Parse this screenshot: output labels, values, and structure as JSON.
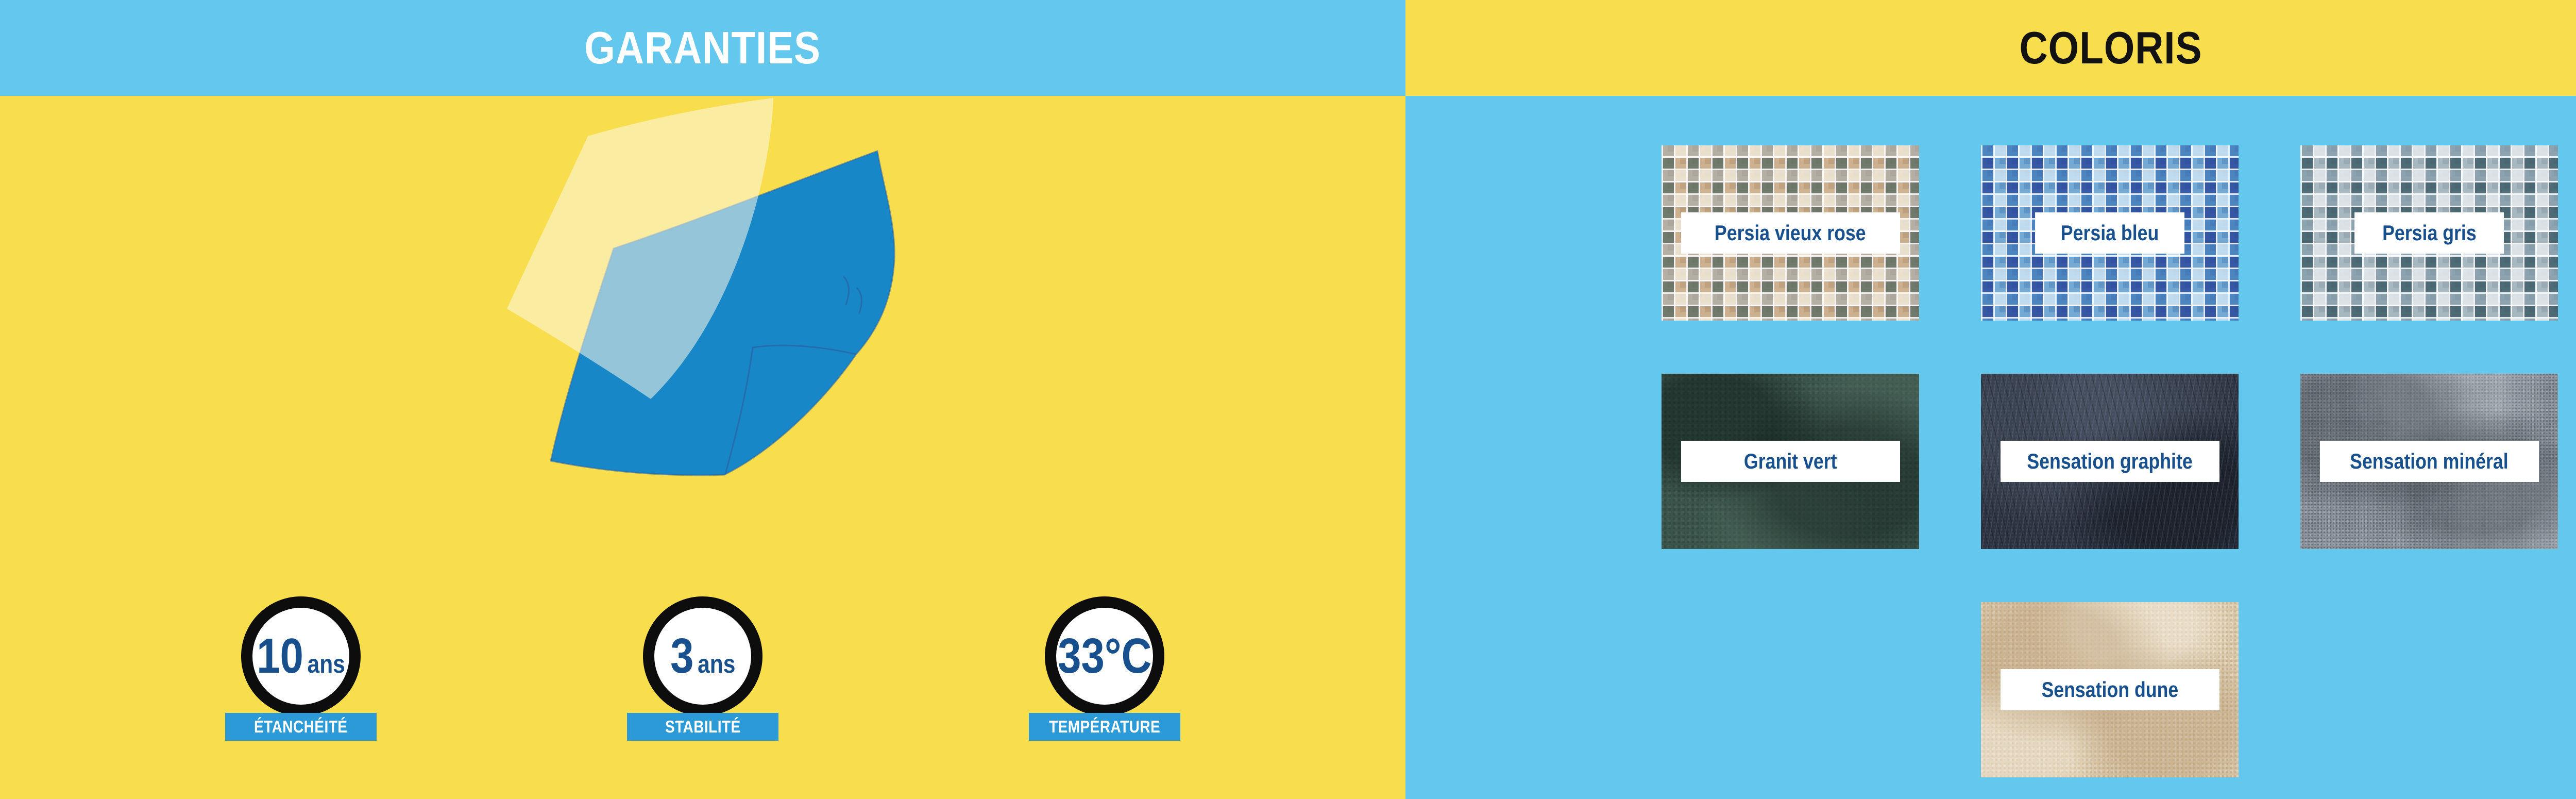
{
  "left_panel": {
    "title": "GARANTIES",
    "illustration": "overlapping-pool-liner-sheets",
    "badges": [
      {
        "value": "10",
        "unit": "ans",
        "label": "ÉTANCHÉITÉ"
      },
      {
        "value": "3",
        "unit": "ans",
        "label": "STABILITÉ"
      },
      {
        "value": "33°C",
        "unit": "",
        "label": "TEMPÉRATURE"
      }
    ]
  },
  "right_panel": {
    "title": "COLORIS",
    "swatches": [
      {
        "name": "Persia vieux rose",
        "texture": "mosaic-rose",
        "label_width": "wide"
      },
      {
        "name": "Persia bleu",
        "texture": "mosaic-bleu",
        "label_width": "narrow"
      },
      {
        "name": "Persia gris",
        "texture": "mosaic-gris",
        "label_width": "narrow"
      },
      {
        "name": "Granit vert",
        "texture": "granit-vert",
        "label_width": "wide"
      },
      {
        "name": "Sensation graphite",
        "texture": "graphite",
        "label_width": "wide"
      },
      {
        "name": "Sensation minéral",
        "texture": "mineral",
        "label_width": "wide"
      },
      {
        "name": "Sensation dune",
        "texture": "dune",
        "label_width": "wide"
      }
    ]
  },
  "colors": {
    "panel_yellow": "#F8DE4C",
    "panel_blue": "#63C7EE",
    "badge_bar_blue": "#2B9AD6",
    "navy_text": "#17508C",
    "header_dark_text": "#121212",
    "badge_ring_black": "#0D0D0D",
    "sheet_blue": "#1787C8",
    "sheet_edge_blue": "#2A66A8",
    "sheet_cream": "rgba(252,247,229,0.55)",
    "white": "#FFFFFF"
  }
}
